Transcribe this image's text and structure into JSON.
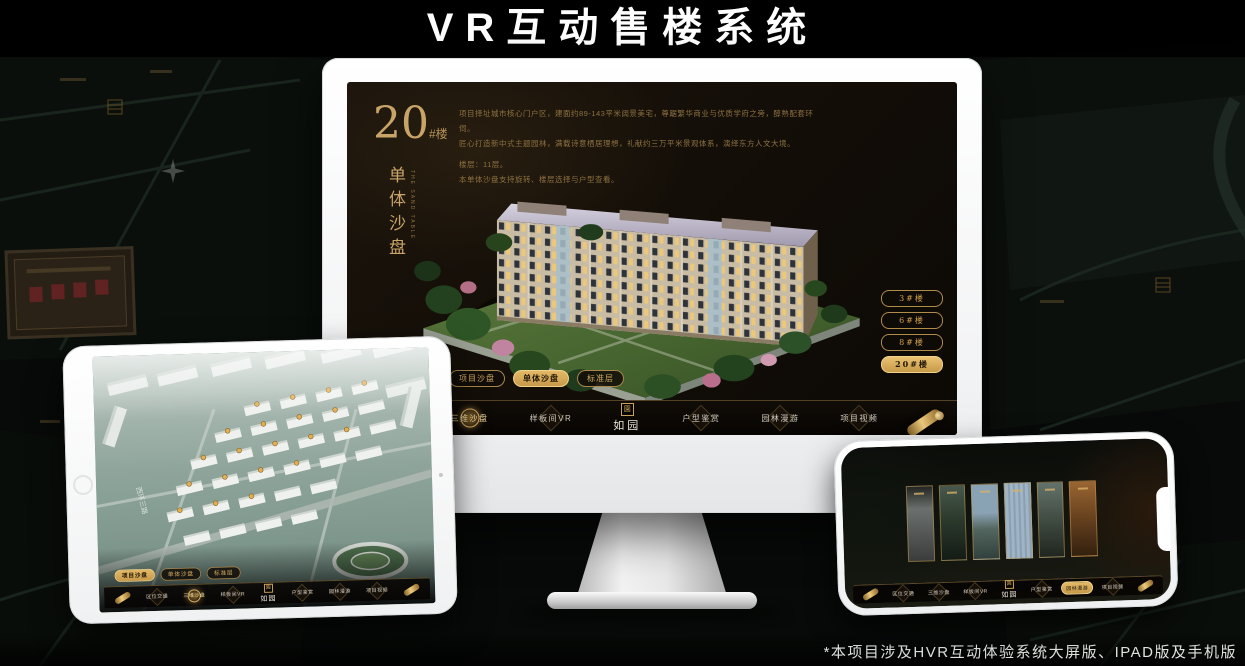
{
  "page": {
    "title": "VR互动售楼系统",
    "footnote": "*本项目涉及HVR互动体验系统大屏版、IPAD版及手机版"
  },
  "colors": {
    "gold": "#c9a05a",
    "gold_bright": "#e3b967",
    "screen_brown": "#17110b",
    "background": "#060806"
  },
  "nav": {
    "logo": "如园",
    "logo_seal": "園",
    "items": [
      "区位交通",
      "三维沙盘",
      "样板间VR",
      "户型鉴赏",
      "园林漫游",
      "项目视频"
    ]
  },
  "desktop": {
    "building_no": "20",
    "building_no_suffix": "#楼",
    "subtitle": "单体沙盘",
    "subtitle_en": "THE SAND TABLE",
    "desc_lines": [
      "项目择址城市核心门户区，建面约89-143平米阔景美宅，尊踞繁华商业与优质学府之旁，醇熟配套环伺。",
      "匠心打造新中式主题园林，满载诗意栖居理想，礼献约三万平米景观体系，演绎东方人文大境。",
      "楼层：11层。",
      "本单体沙盘支持旋转、楼层选择与户型查看。"
    ],
    "floor_buttons": [
      "3#楼",
      "6#楼",
      "8#楼",
      "20#楼"
    ],
    "tabs": [
      "项目沙盘",
      "单体沙盘",
      "标准层"
    ]
  },
  "tablet": {
    "tabs": [
      "项目沙盘",
      "单体沙盘",
      "标准层"
    ],
    "road_label": "西环三路"
  }
}
